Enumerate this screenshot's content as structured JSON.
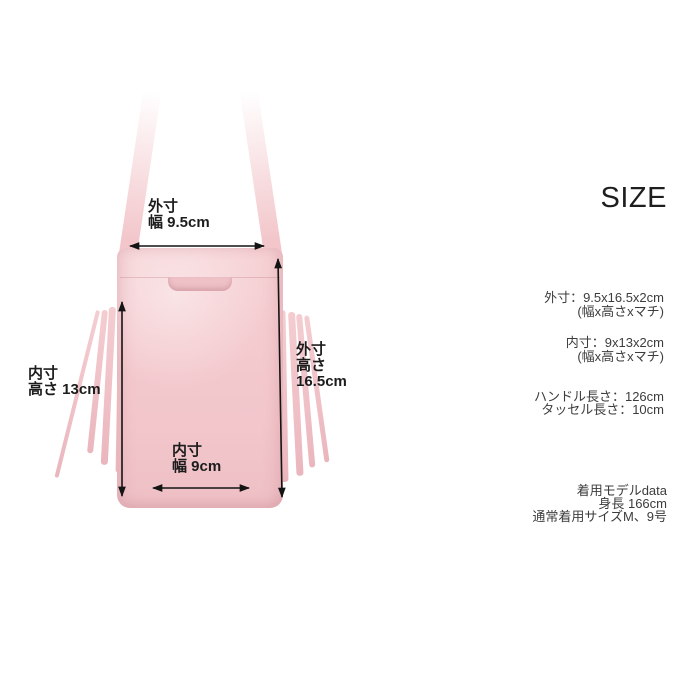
{
  "colors": {
    "bag_pink": "#f3c8cc",
    "bag_pink_dark": "#eab6bd",
    "arrow_black": "#141414",
    "panel_text": "#3c3c3c",
    "heading_text": "#1e1e1e",
    "background": "#ffffff"
  },
  "diagram": {
    "outer_width": [
      "外寸",
      "幅 9.5cm"
    ],
    "inner_height": [
      "内寸",
      "高さ 13cm"
    ],
    "outer_height": [
      "外寸",
      "高さ",
      "16.5cm"
    ],
    "inner_width": [
      "内寸",
      "幅 9cm"
    ]
  },
  "panel": {
    "heading": "SIZE",
    "outer_size": "外寸：9.5x16.5x2cm",
    "outer_note": "(幅x高さxマチ)",
    "inner_size": "内寸：9x13x2cm",
    "inner_note": "(幅x高さxマチ)",
    "handle_length": "ハンドル長さ：126cm",
    "tassel_length": "タッセル長さ：10cm",
    "model": [
      "着用モデルdata",
      "身長 166cm",
      "通常着用サイズM、9号"
    ]
  }
}
